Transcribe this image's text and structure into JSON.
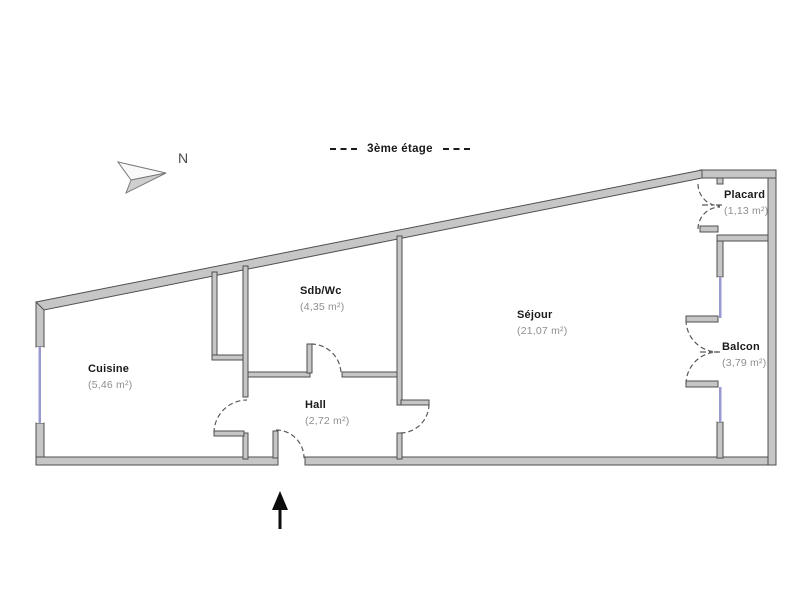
{
  "header": {
    "title": "3ème étage"
  },
  "compass": {
    "label": "N"
  },
  "rooms": [
    {
      "id": "cuisine",
      "name": "Cuisine",
      "area": "(5,46 m²)"
    },
    {
      "id": "sdbwc",
      "name": "Sdb/Wc",
      "area": "(4,35 m²)"
    },
    {
      "id": "hall",
      "name": "Hall",
      "area": "(2,72 m²)"
    },
    {
      "id": "sejour",
      "name": "Séjour",
      "area": "(21,07 m²)"
    },
    {
      "id": "placard",
      "name": "Placard",
      "area": "(1,13 m²)"
    },
    {
      "id": "balcon",
      "name": "Balcon",
      "area": "(3,79 m²)"
    }
  ],
  "colors": {
    "wall_fill": "#c6c6c6",
    "wall_stroke": "#4f4f4f",
    "window": "#9a9ad2",
    "door_arc": "#5a5a5a",
    "text_primary": "#1a1a1a",
    "text_area": "#8f8f8f",
    "entrance_arrow": "#0d0d0d"
  }
}
